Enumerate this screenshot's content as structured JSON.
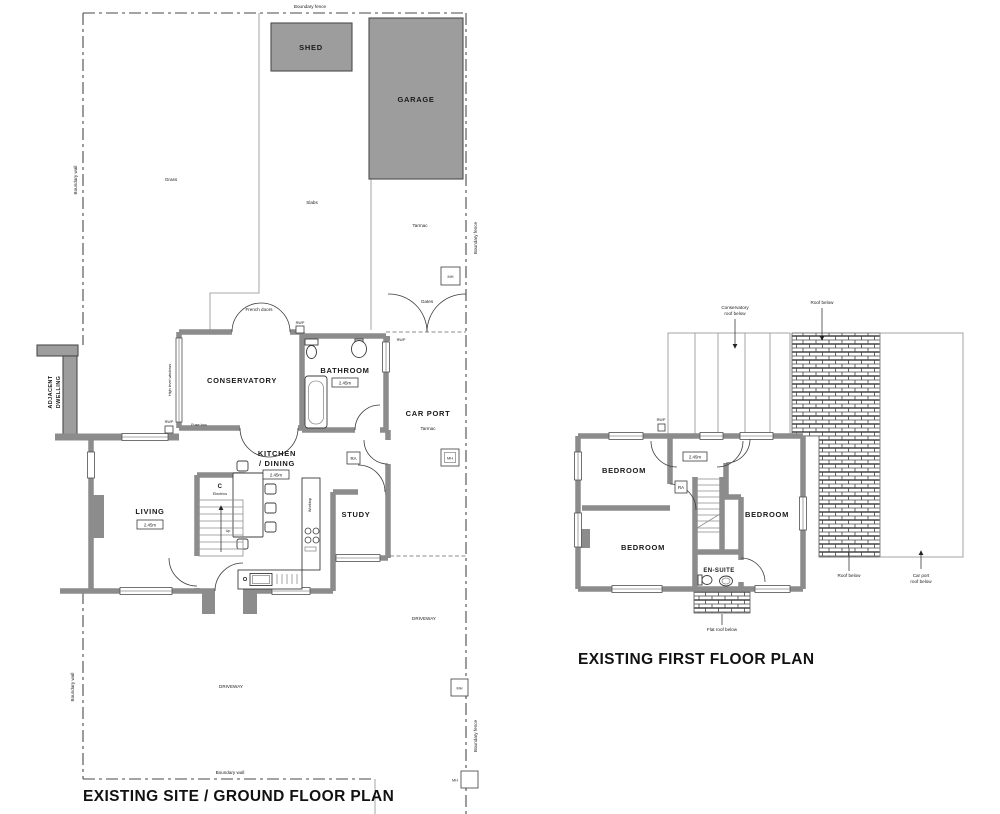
{
  "titles": {
    "ground": "EXISTING SITE / GROUND FLOOR PLAN",
    "first": "EXISTING FIRST FLOOR PLAN"
  },
  "common": {
    "rwp": "RWP",
    "ra": "RA",
    "mh": "MH",
    "up": "Up",
    "height": "2.45m",
    "boundary_fence": "Boundary fence",
    "boundary_wall": "Boundary wall",
    "driveway": "DRIVEWAY",
    "tarmac": "Tarmac"
  },
  "site": {
    "shed": "SHED",
    "garage": "GARAGE",
    "grass": "Grass",
    "slabs": "Slabs",
    "gates": "Gates",
    "adjacent_1": "ADJACENT",
    "adjacent_2": "DWELLING"
  },
  "ground": {
    "conservatory": "CONSERVATORY",
    "bathroom": "BATHROOM",
    "kitchen_1": "KITCHEN",
    "kitchen_2": "/ DINING",
    "living": "LIVING",
    "study": "STUDY",
    "carport": "CAR PORT",
    "cupboard": "C",
    "electrics": "Electrics",
    "worktop": "Worktop",
    "fuse_box": "Fuse box",
    "french_doors": "French doors",
    "high_level_windows": "High level windows"
  },
  "first": {
    "bedroom": "BEDROOM",
    "ensuite": "EN-SUITE",
    "conservatory_roof_1": "Conservatory",
    "conservatory_roof_2": "roof below",
    "roof_below": "Roof below",
    "carport_roof_1": "Car port",
    "carport_roof_2": "roof below",
    "flat_roof": "Flat roof below"
  },
  "colors": {
    "wall": "#8c8c8c",
    "building_fill": "#9d9d9d",
    "line": "#3c3c3c"
  }
}
